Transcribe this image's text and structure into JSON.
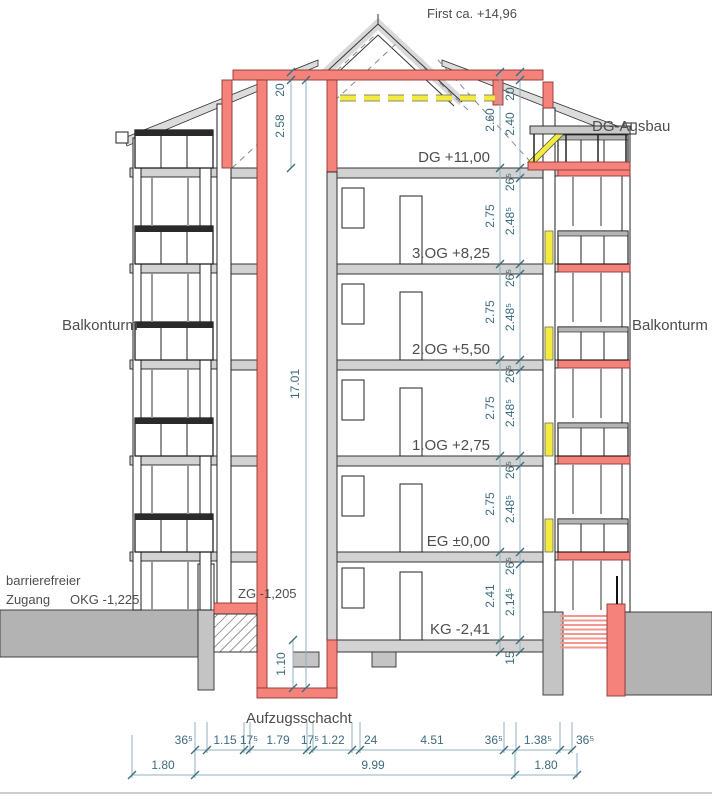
{
  "title": "First ca. +14,96",
  "annotations": {
    "dg_ausbau": "DG-Ausbau",
    "balkonturm_left": "Balkonturm",
    "balkonturm_right": "Balkonturm",
    "barrierefrei_line1": "barrierefreier",
    "barrierefrei_line2": "Zugang",
    "okg": "OKG -1,225",
    "zg": "ZG -1,205",
    "aufzugsschacht": "Aufzugsschacht"
  },
  "floors": [
    {
      "label": "DG +11,00"
    },
    {
      "label": "3.OG +8,25"
    },
    {
      "label": "2.OG +5,50"
    },
    {
      "label": "1.OG +2,75"
    },
    {
      "label": "EG ±0,00"
    },
    {
      "label": "KG -2,41"
    }
  ],
  "vdims": {
    "attic_left_20": "20",
    "attic_left_h": "2.58",
    "attic_right_20": "20",
    "attic_right_a": "2.60",
    "attic_right_b": "2.40",
    "total": "17.01",
    "pit": "1.10",
    "story": [
      "2.75",
      "2.75",
      "2.75",
      "2.75"
    ],
    "kg_story": "2.41",
    "clear": [
      "2.48⁵",
      "2.48⁵",
      "2.48⁵",
      "2.48⁵"
    ],
    "kg_clear": "2.14⁵",
    "slab": [
      "26⁵",
      "26⁵",
      "26⁵",
      "26⁵",
      "26⁵"
    ],
    "kg_slab": "15"
  },
  "bottom_dims": {
    "row1": [
      "36⁵",
      "1.15",
      "17⁵",
      "1.79",
      "17⁵",
      "1.22",
      "24",
      "4.51",
      "36⁵",
      "1.38⁵",
      "36⁵"
    ],
    "row2": [
      "1.80",
      "9.99",
      "1.80"
    ]
  },
  "colors": {
    "section_red": "#f5837c",
    "insulation_yellow": "#f3ec3f",
    "dimension_teal": "#3c6b7e",
    "wall_gray": "#d2d2d2"
  }
}
